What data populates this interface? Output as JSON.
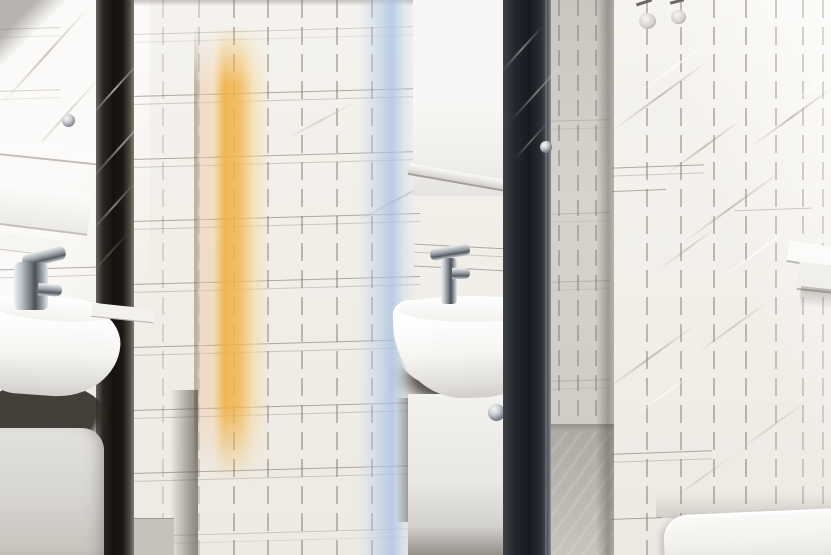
{
  "scene": {
    "type": "photograph",
    "description": "Bright narrow bathroom lined with white square tiles: a white washbasin with chrome mixer tap over a pale vanity, its twin reflected at the left, a sunlit amber wooden door edge, a pale blue vertical light reflection, a tall dark blue-grey open door with a small chrome knob, a doorway showing grey tiled floor, small glass wall lamps, a white corner shelf on the right wall and the top of a white toilet cistern in the lower right corner.",
    "objects": [
      {
        "name": "tiled-wall",
        "label": "white square wall tiles with grey grout"
      },
      {
        "name": "left-washbasin",
        "label": "white ceramic washbasin with chrome mixer tap"
      },
      {
        "name": "left-pedestal",
        "label": "light grey basin pedestal"
      },
      {
        "name": "mirror-edge",
        "label": "dark mirror edge with metallic reflections"
      },
      {
        "name": "amber-door",
        "label": "sunlit amber wooden door edge"
      },
      {
        "name": "blue-reflection",
        "label": "pale blue vertical light reflection"
      },
      {
        "name": "wall-cabinet",
        "label": "white wall cabinet above the basin"
      },
      {
        "name": "center-washbasin",
        "label": "white washbasin with chrome mixer tap"
      },
      {
        "name": "vanity",
        "label": "white vanity cabinet with round chrome knob"
      },
      {
        "name": "dark-door",
        "label": "tall dark blue-grey open door with chrome knob"
      },
      {
        "name": "doorway",
        "label": "doorway opening onto grey tiled floor"
      },
      {
        "name": "right-wall",
        "label": "bright tiled wall with diagonal light reflections"
      },
      {
        "name": "wall-lights",
        "label": "two small glass wall lamps"
      },
      {
        "name": "corner-shelf",
        "label": "white ceramic corner shelf"
      },
      {
        "name": "toilet-cistern",
        "label": "top of a white toilet cistern"
      }
    ]
  },
  "palette": {
    "tile_white": "#f1eee8",
    "tile_bright": "#faf9f6",
    "grout_grey": "#9a948a",
    "amber": "#efae3f",
    "amber_pink": "#ecd0c0",
    "pale_blue": "#aec6e4",
    "dark_door": "#1a1c21",
    "dark_edge": "#141210",
    "chrome": "#aab0b7",
    "porcelain": "#fdfdfc",
    "vanity_grey": "#e6e4e0",
    "floor_grey": "#b4b0a9",
    "shadow_brown": "#332f29"
  }
}
